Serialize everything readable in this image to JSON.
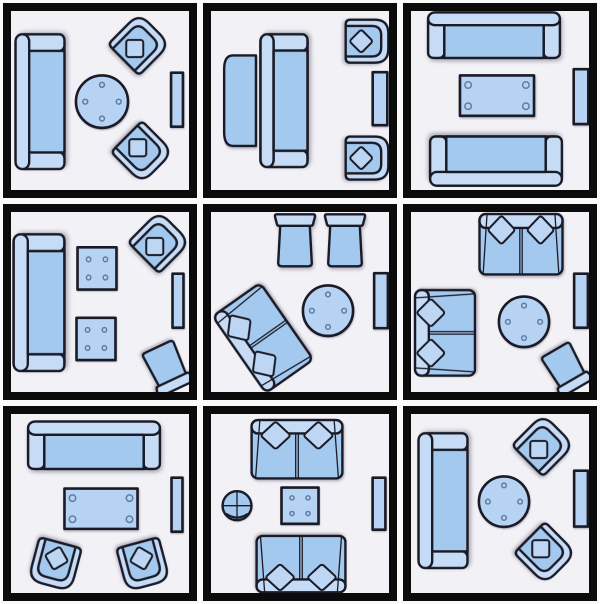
{
  "figure": {
    "type": "furniture-layout-grid",
    "description": "Nine small living room furniture arrangement floor plans in a 3x3 grid",
    "rows": 3,
    "cols": 3
  },
  "colors": {
    "outline": "#1a1b26",
    "furniture_main": "#a4c9ef",
    "furniture_light": "#c6dcf6",
    "pillow": "#bdd6f4",
    "table": "#b7d3f3",
    "ring": "#5f7ca8",
    "room_bg": "#f2f1f6",
    "frame": "#0b0b0c",
    "gap_bg": "#fafafa"
  },
  "rooms": [
    {
      "name": "sofa-round-table-two-angled-armchairs",
      "items": [
        {
          "type": "sofa",
          "cx": 29,
          "cy": 90,
          "w": 137,
          "h": 52,
          "rot": 270
        },
        {
          "type": "roundtable",
          "cx": 91,
          "cy": 90,
          "w": 54,
          "h": 54,
          "rot": 0
        },
        {
          "type": "armchair",
          "cx": 128,
          "cy": 33,
          "w": 46,
          "h": 46,
          "rot": 45
        },
        {
          "type": "armchair",
          "cx": 131,
          "cy": 140,
          "w": 46,
          "h": 46,
          "rot": 135
        },
        {
          "type": "sidetable",
          "cx": 166,
          "cy": 88,
          "w": 13,
          "h": 55,
          "rot": 0
        }
      ]
    },
    {
      "name": "sofa-with-console-two-armchairs",
      "items": [
        {
          "type": "console",
          "cx": 29,
          "cy": 89,
          "w": 33,
          "h": 92,
          "rot": 0
        },
        {
          "type": "sofa",
          "cx": 73,
          "cy": 89,
          "w": 135,
          "h": 50,
          "rot": 270
        },
        {
          "type": "armchair",
          "cx": 156,
          "cy": 30,
          "w": 45,
          "h": 45,
          "rot": 90
        },
        {
          "type": "armchair",
          "cx": 156,
          "cy": 146,
          "w": 45,
          "h": 45,
          "rot": 90
        },
        {
          "type": "sidetable",
          "cx": 169,
          "cy": 87,
          "w": 16,
          "h": 54,
          "rot": 0
        }
      ]
    },
    {
      "name": "two-facing-sofas-coffee-table",
      "items": [
        {
          "type": "sofa",
          "cx": 83,
          "cy": 24,
          "w": 135,
          "h": 48,
          "rot": 0
        },
        {
          "type": "recttable",
          "cx": 86,
          "cy": 84,
          "w": 76,
          "h": 42,
          "rot": 0
        },
        {
          "type": "sofa",
          "cx": 85,
          "cy": 149,
          "w": 135,
          "h": 52,
          "rot": 180
        },
        {
          "type": "sidetable",
          "cx": 170,
          "cy": 85,
          "w": 16,
          "h": 56,
          "rot": 0
        }
      ]
    },
    {
      "name": "sofa-two-ottoman-tables-armchair-chair",
      "items": [
        {
          "type": "sofa",
          "cx": 28,
          "cy": 90,
          "w": 139,
          "h": 54,
          "rot": 270
        },
        {
          "type": "sqtable",
          "cx": 86,
          "cy": 56,
          "w": 40,
          "h": 43,
          "rot": 0
        },
        {
          "type": "sqtable",
          "cx": 85,
          "cy": 126,
          "w": 40,
          "h": 43,
          "rot": 0
        },
        {
          "type": "armchair",
          "cx": 148,
          "cy": 30,
          "w": 46,
          "h": 46,
          "rot": 45
        },
        {
          "type": "sidetable",
          "cx": 167,
          "cy": 88,
          "w": 12,
          "h": 55,
          "rot": 0
        },
        {
          "type": "chair",
          "cx": 156,
          "cy": 155,
          "w": 42,
          "h": 48,
          "rot": 155
        }
      ]
    },
    {
      "name": "diagonal-loveseat-two-chairs-round-table",
      "items": [
        {
          "type": "chair",
          "cx": 84,
          "cy": 28,
          "w": 42,
          "h": 54,
          "rot": 0
        },
        {
          "type": "chair",
          "cx": 134,
          "cy": 28,
          "w": 42,
          "h": 54,
          "rot": 0
        },
        {
          "type": "loveseat",
          "cx": 52,
          "cy": 125,
          "w": 95,
          "h": 60,
          "rot": 235
        },
        {
          "type": "roundtable",
          "cx": 117,
          "cy": 98,
          "w": 52,
          "h": 52,
          "rot": 0
        },
        {
          "type": "sidetable",
          "cx": 170,
          "cy": 88,
          "w": 15,
          "h": 56,
          "rot": 0
        }
      ]
    },
    {
      "name": "two-loveseats-round-table-corner-chair",
      "items": [
        {
          "type": "loveseat",
          "cx": 110,
          "cy": 32,
          "w": 85,
          "h": 62,
          "rot": 0
        },
        {
          "type": "loveseat",
          "cx": 34,
          "cy": 120,
          "w": 87,
          "h": 62,
          "rot": 270
        },
        {
          "type": "roundtable",
          "cx": 113,
          "cy": 109,
          "w": 52,
          "h": 52,
          "rot": 0
        },
        {
          "type": "sidetable",
          "cx": 170,
          "cy": 88,
          "w": 15,
          "h": 55,
          "rot": 0
        },
        {
          "type": "chair",
          "cx": 155,
          "cy": 156,
          "w": 40,
          "h": 46,
          "rot": 150
        }
      ]
    },
    {
      "name": "sofa-coffee-table-two-armchairs",
      "items": [
        {
          "type": "sofa",
          "cx": 83,
          "cy": 31,
          "w": 135,
          "h": 50,
          "rot": 0
        },
        {
          "type": "recttable",
          "cx": 90,
          "cy": 94,
          "w": 75,
          "h": 42,
          "rot": 0
        },
        {
          "type": "armchair",
          "cx": 44,
          "cy": 149,
          "w": 46,
          "h": 46,
          "rot": 195
        },
        {
          "type": "armchair",
          "cx": 132,
          "cy": 149,
          "w": 46,
          "h": 46,
          "rot": 165
        },
        {
          "type": "sidetable",
          "cx": 166,
          "cy": 90,
          "w": 12,
          "h": 55,
          "rot": 0
        }
      ]
    },
    {
      "name": "facing-loveseats-square-table-pouf",
      "items": [
        {
          "type": "loveseat",
          "cx": 86,
          "cy": 35,
          "w": 93,
          "h": 60,
          "rot": 0
        },
        {
          "type": "pouf",
          "cx": 26,
          "cy": 91,
          "w": 31,
          "h": 31,
          "rot": 0
        },
        {
          "type": "sqtable",
          "cx": 89,
          "cy": 91,
          "w": 38,
          "h": 37,
          "rot": 0
        },
        {
          "type": "loveseat",
          "cx": 90,
          "cy": 149,
          "w": 91,
          "h": 58,
          "rot": 180
        },
        {
          "type": "sidetable",
          "cx": 168,
          "cy": 89,
          "w": 14,
          "h": 53,
          "rot": 0
        }
      ]
    },
    {
      "name": "sofa-round-table-two-angled-armchairs-2",
      "items": [
        {
          "type": "sofa",
          "cx": 32,
          "cy": 86,
          "w": 137,
          "h": 52,
          "rot": 270
        },
        {
          "type": "roundtable",
          "cx": 93,
          "cy": 87,
          "w": 52,
          "h": 52,
          "rot": 0
        },
        {
          "type": "armchair",
          "cx": 132,
          "cy": 31,
          "w": 46,
          "h": 46,
          "rot": 45
        },
        {
          "type": "armchair",
          "cx": 134,
          "cy": 138,
          "w": 46,
          "h": 46,
          "rot": 135
        },
        {
          "type": "sidetable",
          "cx": 170,
          "cy": 84,
          "w": 15,
          "h": 57,
          "rot": 0
        }
      ]
    }
  ]
}
